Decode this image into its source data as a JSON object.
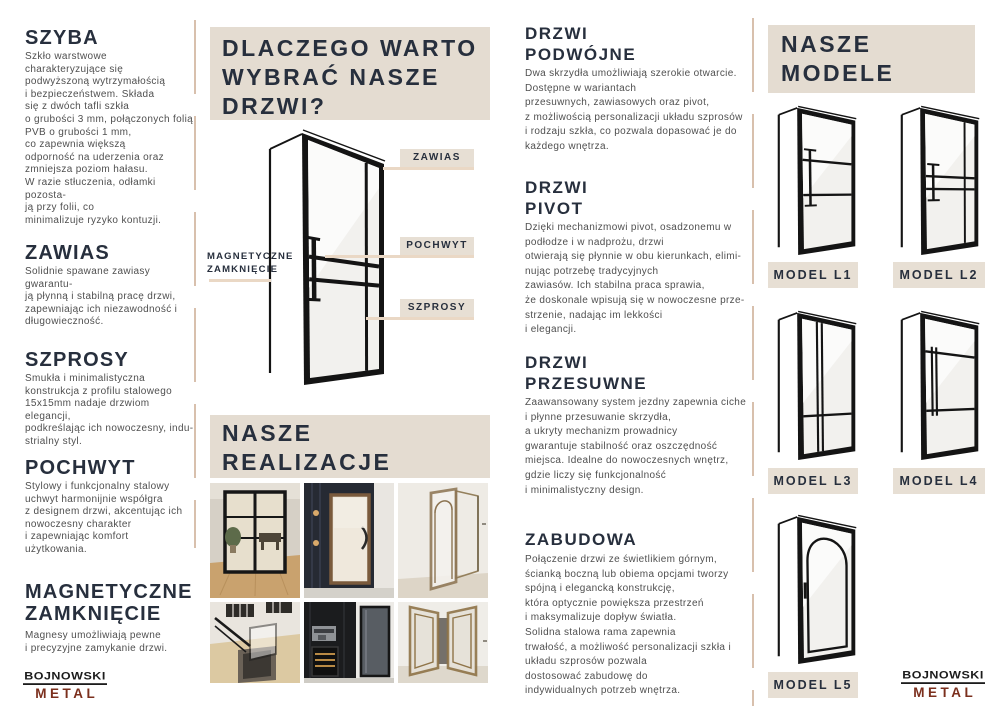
{
  "colors": {
    "beige_block": "#e4dcd1",
    "label_beige": "#e7dfd4",
    "connector_line": "#ead8c5",
    "divider": "#d8c0ad",
    "heading_navy": "#272f3d",
    "body_gray": "#4f4f4f",
    "door_black": "#141414",
    "logo_maroon": "#7b2f1d"
  },
  "left_column": {
    "sections": [
      {
        "title": "SZYBA",
        "body": "Szkło warstwowe\ncharakteryzujące się\npodwyższoną wytrzymałością\ni bezpieczeństwem. Składa\nsię z dwóch tafli szkła\no grubości 3 mm, połączonych folią\nPVB o grubości 1 mm,\nco zapewnia większą\nodporność na uderzenia oraz\nzmniejsza poziom hałasu.\nW razie stłuczenia, odłamki pozosta-\nją przy folii, co\nminimalizuje ryzyko kontuzji."
      },
      {
        "title": "ZAWIAS",
        "body": "Solidnie spawane zawiasy gwarantu-\nją płynną i stabilną pracę drzwi,\nzapewniając ich niezawodność i\ndługowieczność."
      },
      {
        "title": "SZPROSY",
        "body": "Smukła i minimalistyczna\nkonstrukcja z profilu stalowego\n15x15mm nadaje drzwiom elegancji,\npodkreślając ich nowoczesny, indu-\nstrialny styl."
      },
      {
        "title": "POCHWYT",
        "body": "Stylowy i funkcjonalny stalowy\nuchwyt harmonijnie współgra\nz designem drzwi, akcentując ich\nnowoczesny charakter\ni zapewniając komfort\nużytkowania."
      },
      {
        "title": "MAGNETYCZNE\nZAMKNIĘCIE",
        "body": "Magnesy umożliwiają pewne\ni precyzyjne zamykanie drzwi."
      }
    ],
    "logo": {
      "name": "BOJNOWSKI",
      "sub": "METAL"
    }
  },
  "center_column": {
    "why_heading": "DLACZEGO WARTO\nWYBRAĆ NASZE\nDRZWI?",
    "diagram": {
      "labels": {
        "zawias": "ZAWIAS",
        "pochwyt": "POCHWYT",
        "szprosy": "SZPROSY",
        "magnetyczne": "MAGNETYCZNE\nZAMKNIĘCIE"
      }
    },
    "realizacje_heading": "NASZE\nREALIZACJE",
    "photos": [
      "black-framed double glass doors in dining room",
      "frosted glass door with wooden frame on dark panelled wall",
      "bronze framed glass door opened in white hallway",
      "staircase with black railing and glass balustrade",
      "black cabinetry with coffee machine, wine fridge and smoked glass door",
      "bronze double doors with decorative glass panels"
    ]
  },
  "right_column": {
    "sections": [
      {
        "title": "DRZWI\nPODWÓJNE",
        "body": "Dwa skrzydła umożliwiają szerokie otwarcie.\nDostępne w wariantach\nprzesuwnych, zawiasowych oraz pivot,\nz możliwością personalizacji układu szprosów\ni rodzaju szkła, co pozwala dopasować je do\nkażdego wnętrza."
      },
      {
        "title": "DRZWI\nPIVOT",
        "body": "Dzięki mechanizmowi pivot, osadzonemu w\npodłodze i w nadprożu, drzwi\notwierają się płynnie w obu kierunkach, elimi-\nnując potrzebę tradycyjnych\nzawiasów. Ich stabilna praca sprawia,\nże doskonale wpisują się w nowoczesne prze-\nstrzenie, nadając im lekkości\ni elegancji."
      },
      {
        "title": "DRZWI\nPRZESUWNE",
        "body": "Zaawansowany system jezdny zapewnia ciche\ni płynne przesuwanie skrzydła,\na ukryty mechanizm prowadnicy\ngwarantuje stabilność oraz oszczędność\nmiejsca. Idealne do nowoczesnych wnętrz,\ngdzie liczy się funkcjonalność\ni minimalistyczny design."
      },
      {
        "title": "ZABUDOWA",
        "body": "Połączenie drzwi ze świetlikiem górnym,\nścianką boczną lub obiema opcjami tworzy\nspójną i elegancką konstrukcję,\nktóra optycznie powiększa przestrzeń\ni maksymalizuje dopływ światła.\nSolidna stalowa rama zapewnia\ntrwałość, a możliwość personalizacji szkła i\nukładu szprosów pozwala\ndostosować zabudowę do\nindywidualnych potrzeb wnętrza."
      }
    ]
  },
  "models_column": {
    "heading": "NASZE\nMODELE",
    "models": [
      {
        "label": "MODEL L1"
      },
      {
        "label": "MODEL L2"
      },
      {
        "label": "MODEL L3"
      },
      {
        "label": "MODEL L4"
      },
      {
        "label": "MODEL L5"
      }
    ],
    "logo": {
      "name": "BOJNOWSKI",
      "sub": "METAL"
    }
  }
}
